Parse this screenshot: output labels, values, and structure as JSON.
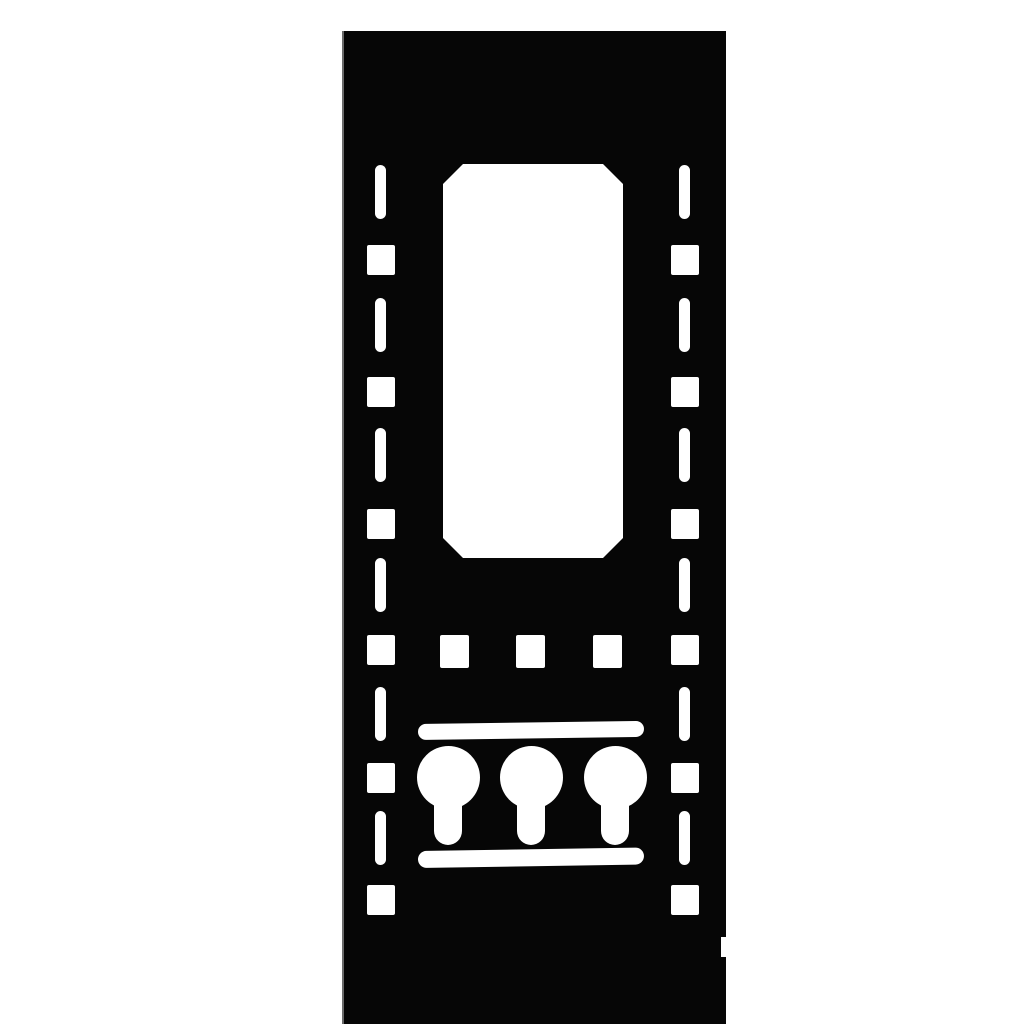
{
  "meta": {
    "description": "Black punched steel vertical rack-rail panel with cutouts, product image on white background",
    "background_color": "#ffffff",
    "panel_color": "#060606",
    "cutout_color": "#ffffff",
    "edge_highlight_color": "#969696"
  },
  "figure": {
    "panel": {
      "left": 342,
      "top": 31,
      "width": 384,
      "height": 993
    },
    "window": {
      "left": 101,
      "top": 133,
      "width": 180,
      "height": 394,
      "chamfer": 20
    },
    "rail": {
      "slot": {
        "width": 11,
        "height": 54,
        "radius": 6
      },
      "square": {
        "width": 28,
        "height": 30
      },
      "columns": [
        {
          "side": "left",
          "slot_x": 33,
          "square_x": 25
        },
        {
          "side": "right",
          "slot_x": 337,
          "square_x": 329
        }
      ],
      "slot_tops": [
        134,
        267,
        397,
        527,
        656,
        780
      ],
      "square_tops": [
        214,
        346,
        478,
        604,
        732,
        854
      ]
    },
    "vent_squares": {
      "y": 604,
      "width": 29,
      "height": 33,
      "xs": [
        98,
        174,
        251
      ]
    },
    "bars": [
      {
        "name": "top-slot-bar",
        "left": 76,
        "top": 693,
        "width": 226,
        "height": 16,
        "tilt_deg": -0.8
      },
      {
        "name": "bottom-slot-bar",
        "left": 76,
        "top": 820,
        "width": 226,
        "height": 17,
        "tilt_deg": -0.9
      }
    ],
    "keyholes": {
      "circle_diameter": 63,
      "circle_center_y": 746,
      "stem_width": 28,
      "stem_bottom_y": 814,
      "stem_radius": 14,
      "centers_x": [
        106,
        189,
        273
      ]
    },
    "edge_notch": {
      "top": 906,
      "width": 5,
      "height": 20
    }
  }
}
